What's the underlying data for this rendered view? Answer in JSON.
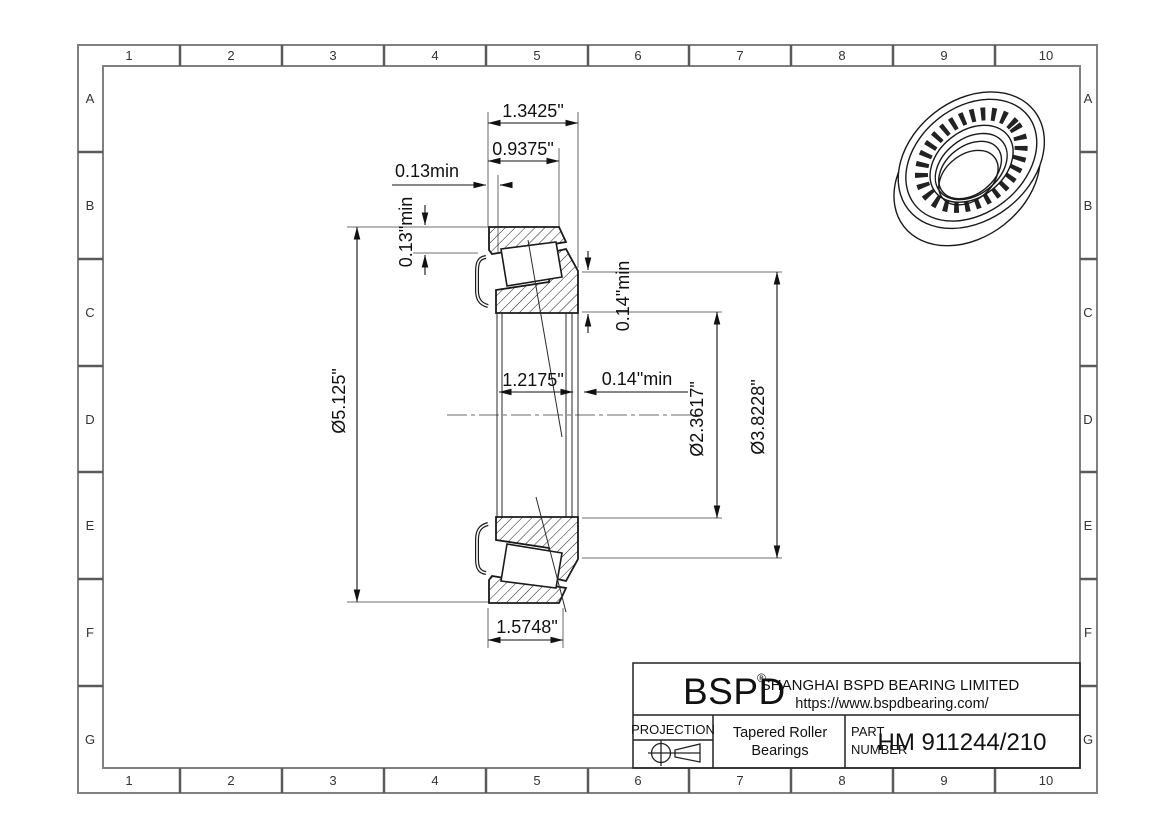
{
  "drawing": {
    "grid": {
      "columns": [
        "1",
        "2",
        "3",
        "4",
        "5",
        "6",
        "7",
        "8",
        "9",
        "10"
      ],
      "rows": [
        "A",
        "B",
        "C",
        "D",
        "E",
        "F",
        "G"
      ]
    },
    "dims": {
      "overall_width": "1.3425\"",
      "cup_width": "0.9375\"",
      "front_clearance": "0.13min",
      "front_clearance_radial": "0.13\"min",
      "cone_front_width": "1.2175\"",
      "back_clearance": "0.14\"min",
      "back_clearance_radial": "0.14\"min",
      "outer_diameter": "Ø5.125\"",
      "bore_diameter": "Ø2.3617\"",
      "flange_diameter": "Ø3.8228\"",
      "cone_width": "1.5748\""
    }
  },
  "title_block": {
    "logo": "BSPD",
    "registered": "®",
    "company": "SHANGHAI BSPD BEARING LIMITED",
    "website": "https://www.bspdbearing.com/",
    "projection_label": "PROJECTION",
    "product_line1": "Tapered Roller",
    "product_line2": "Bearings",
    "part_label_line1": "PART",
    "part_label_line2": "NUMBER",
    "part_number": "HM 911244/210"
  },
  "colors": {
    "line": "#1a1a1a",
    "frame": "#808080",
    "dimension": "#111111",
    "background": "#ffffff"
  }
}
